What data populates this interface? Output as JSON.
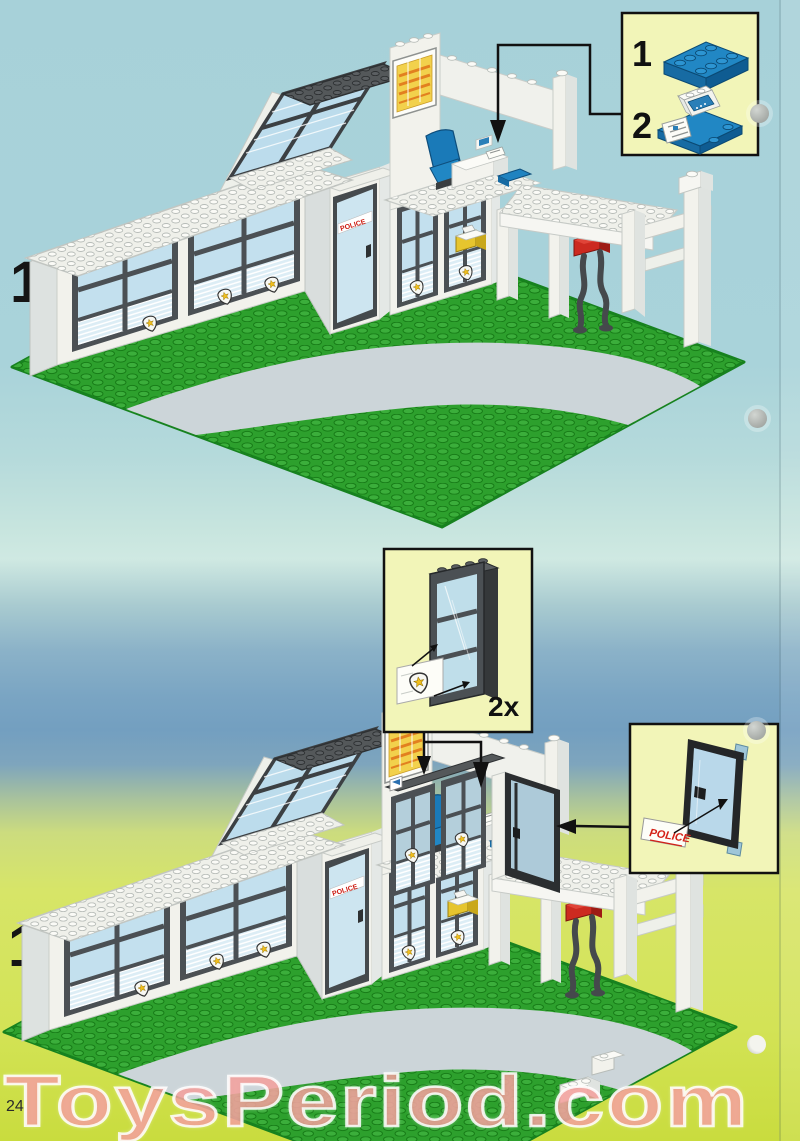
{
  "page": {
    "number": "24",
    "watermark": "ToysPeriod.com"
  },
  "steps": {
    "step12": {
      "label": "12"
    },
    "step13": {
      "label": "13"
    }
  },
  "parts_callout": {
    "item1_index": "1",
    "item1_part": "blue-plate-2x4",
    "item2_index": "2",
    "item2_part": "blue-plate-with-radio-console-and-map-tile"
  },
  "window_callout": {
    "quantity": "2x",
    "part": "dark-gray-window-frame-with-police-badge-sticker"
  },
  "door_callout": {
    "sticker_label": "POLICE",
    "part": "black-glass-door-with-police-sticker"
  },
  "building": {
    "door_sticker_label": "POLICE"
  },
  "colors": {
    "background_sky": "#a9d3da",
    "background_band": "#739fc0",
    "background_ground": "#d3e356",
    "callout_fill": "#f2f5b8",
    "baseplate_green": "#2da02d",
    "stud_green": "#3bae3b",
    "road_gray": "#ccd5d9",
    "wall_white": "#f2f2ec",
    "frame_dark_gray": "#4b5054",
    "glass_blue": "#c3e0ee",
    "lego_blue": "#1f83c4",
    "accent_red": "#cc2a20",
    "accent_yellow": "#e6c52e",
    "watermark_pink": "#f29b95",
    "badge_yellow": "#f0be1c"
  }
}
